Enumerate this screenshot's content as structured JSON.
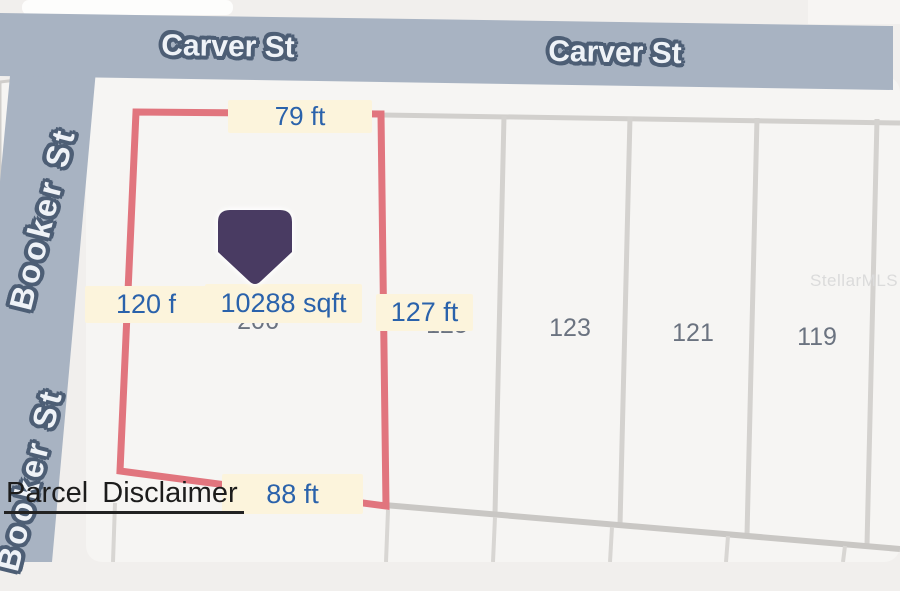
{
  "map": {
    "street_carver": "Carver St",
    "street_booker": "Booker St",
    "lot": {
      "number": "206",
      "area_label": "10288 sqft",
      "width_top": "79 ft",
      "depth_left": "120 f",
      "depth_right": "127 ft",
      "width_bottom": "88 ft"
    },
    "parcel_numbers": [
      "125",
      "123",
      "121",
      "119"
    ],
    "watermark": "StellarMLS",
    "disclaimer_link": "Parcel Disclaimer",
    "colors": {
      "street_fill": "#a8b3c2",
      "boundary_red": "#e1757e",
      "dimension_label_bg": "#fcf4dc",
      "dimension_text": "#2a62ab",
      "marker_purple": "#493b62",
      "parcel_number_gray": "#6b7380"
    }
  }
}
